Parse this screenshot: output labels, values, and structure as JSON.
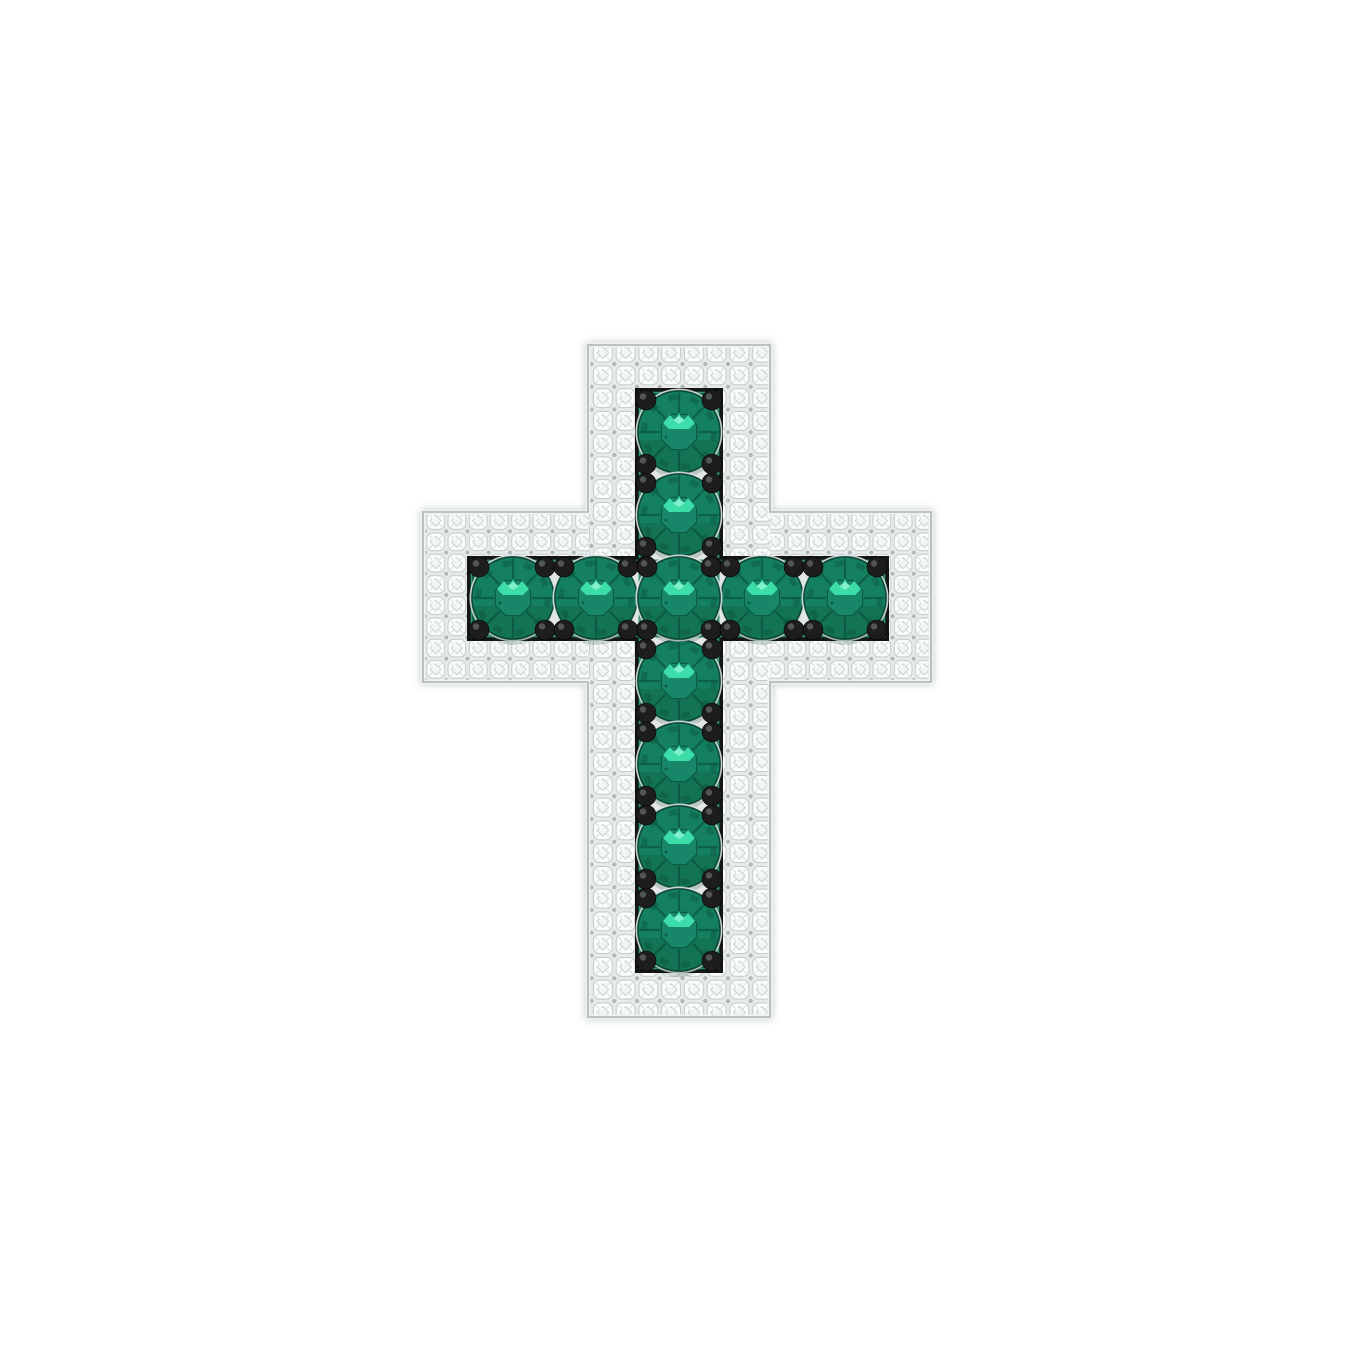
{
  "scene": {
    "description": "White gold latin cross pendant paved with small white diamonds along its border, set with eleven round green emeralds in a black-framed center channel with black bead prongs, photographed on a plain white background",
    "object_type": "cross-pendant-jewelry",
    "background_color": "#ffffff"
  },
  "pendant": {
    "style": "latin-cross",
    "frame_material": "white gold with pave diamond border",
    "center_stones": "round emeralds",
    "prong_color": "black",
    "stone_counts": {
      "emeralds_vertical": 7,
      "emeralds_horizontal": 5,
      "emeralds_total": 11,
      "pave_rows_per_band": 2
    }
  },
  "colors": {
    "background": "#ffffff",
    "metal_base": "#ebeeee",
    "metal_rim": "#f0f3f3",
    "metal_ring": "#dce1e1",
    "outline_gray": "#aeb4b5",
    "pattern_bg": "#e7ebeb",
    "pave_fill": "#fbfdfd",
    "pave_stroke": "#c7cdcd",
    "pave_facet": "#dde3e3",
    "pave_center": "#f1f5f5",
    "bead_gray": "#b2b8b8",
    "channel_black": "#151515",
    "channel_metal": "#e2e6e6",
    "channel_green": "#0f7b58",
    "channel_green_dark": "#0a5a40",
    "emerald_base": "#15805f",
    "emerald_mid": "#1b8c69",
    "emerald_dark": "#0c5a43",
    "emerald_edge": "#0b4a38",
    "emerald_table": "#19876a",
    "emerald_highlight": "#3fe2ae",
    "emerald_highlight2": "#8bf4d2",
    "emerald_shadow": "#0a3f2f",
    "prong_black": "#1d1d1d",
    "prong_highlight": "#5a5f5e"
  },
  "geometry": {
    "canvas": {
      "width": 1360,
      "height": 1360
    },
    "vertical_bar": {
      "x": 588,
      "y": 345,
      "w": 182,
      "h": 672
    },
    "horizontal_bar": {
      "x": 423,
      "y": 512,
      "w": 508,
      "h": 170
    },
    "vertical_channel": {
      "x": 635,
      "y": 388,
      "w": 88,
      "h": 585
    },
    "horizontal_channel": {
      "x": 467,
      "y": 556,
      "w": 422,
      "h": 85
    },
    "pave_tile_vertical": 22.75,
    "pave_tile_horizontal": 21.25,
    "gem_radius": 41,
    "gems": {
      "vertical_x": 679,
      "vertical_ys": [
        432,
        515,
        598,
        681,
        764,
        847,
        930
      ],
      "horizontal_y": 598,
      "horizontal_xs": [
        513,
        596,
        679,
        762,
        845
      ]
    },
    "prongs": {
      "radius": 10,
      "pair_offset": 9.5,
      "vertical_wall_xs": [
        646,
        712
      ],
      "vertical_end_ys": [
        400,
        961
      ],
      "horizontal_wall_ys": [
        567,
        630
      ],
      "horizontal_end_xs": [
        479,
        877
      ]
    }
  }
}
